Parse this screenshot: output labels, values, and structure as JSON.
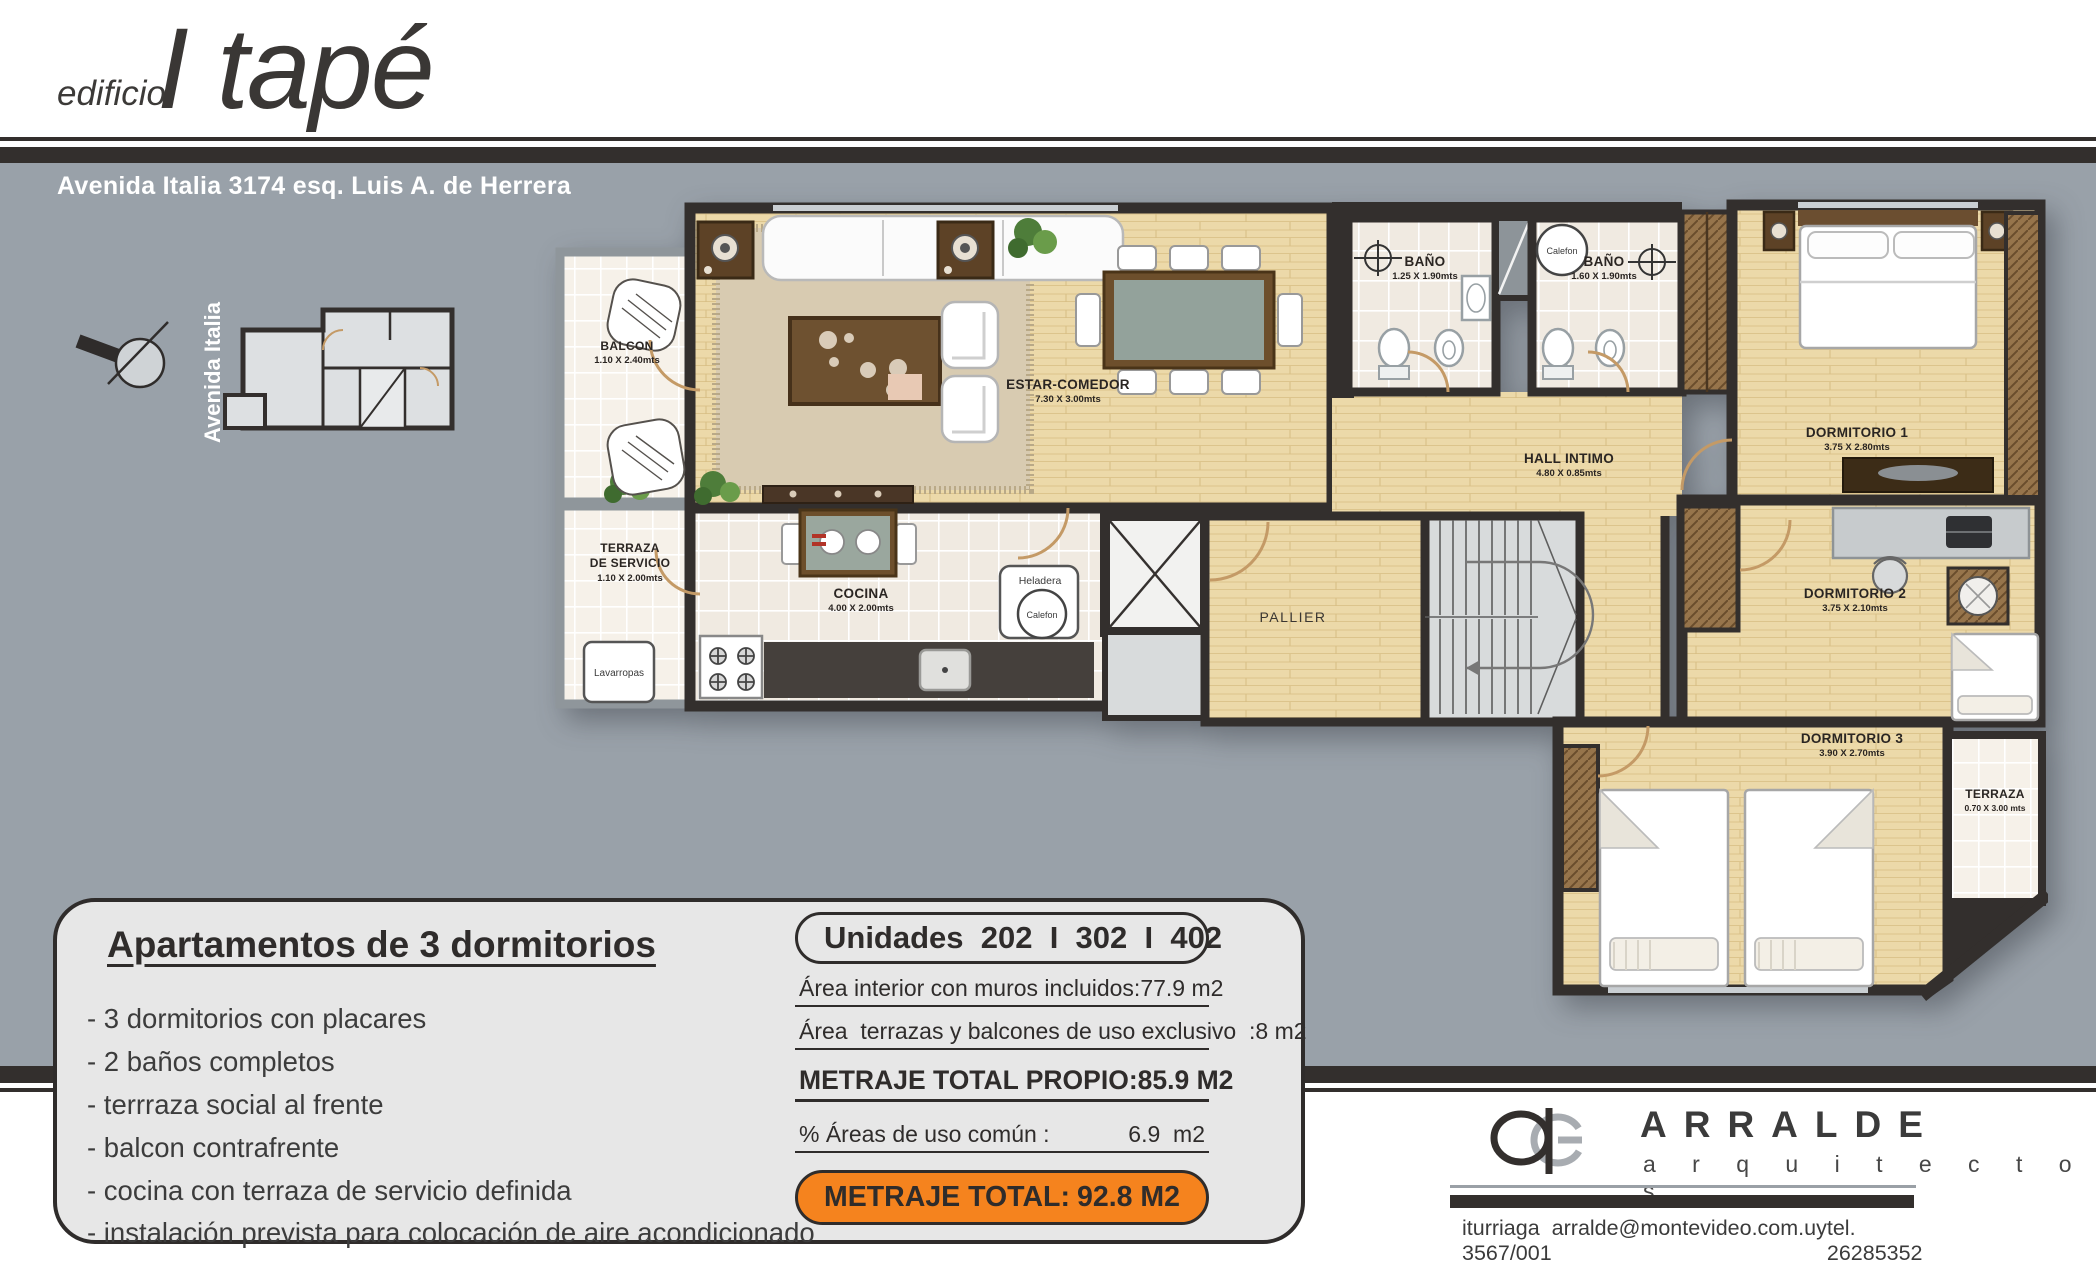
{
  "header": {
    "brand_prefix": "edificio",
    "brand_name": "I tapé",
    "address": "Avenida Italia 3174 esq. Luis A. de Herrera"
  },
  "key_plan": {
    "street_label": "Avenida Italia"
  },
  "plan": {
    "rooms": {
      "balcon": {
        "name": "BALCON",
        "dims": "1.10 X 2.40mts"
      },
      "estar": {
        "name": "ESTAR-COMEDOR",
        "dims": "7.30 X 3.00mts"
      },
      "bano1": {
        "name": "BAÑO",
        "dims": "1.25 X 1.90mts"
      },
      "bano2": {
        "name": "BAÑO",
        "dims": "1.60 X 1.90mts"
      },
      "dorm1": {
        "name": "DORMITORIO 1",
        "dims": "3.75 X 2.80mts"
      },
      "hall": {
        "name": "HALL INTIMO",
        "dims": "4.80 X 0.85mts"
      },
      "dorm2": {
        "name": "DORMITORIO 2",
        "dims": "3.75 X 2.10mts"
      },
      "terraza_servicio": {
        "name_line1": "TERRAZA",
        "name_line2": "DE SERVICIO",
        "dims": "1.10 X 2.00mts"
      },
      "cocina": {
        "name": "COCINA",
        "dims": "4.00 X 2.00mts"
      },
      "pallier": {
        "name": "PALLIER"
      },
      "dorm3": {
        "name": "DORMITORIO 3",
        "dims": "3.90 X 2.70mts"
      },
      "terraza": {
        "name": "TERRAZA",
        "dims": "0.70 X 3.00 mts"
      }
    },
    "labels": {
      "lavarropas": "Lavarropas",
      "heladera": "Heladera",
      "calefon": "Calefon"
    }
  },
  "info_panel": {
    "title": "Apartamentos de 3 dormitorios",
    "features": [
      "- 3 dormitorios con placares",
      "- 2 baños completos",
      "- terrraza social al frente",
      "- balcon contrafrente",
      "- cocina con terraza de servicio definida",
      "- instalación prevista para colocación de aire acondicionado"
    ]
  },
  "units_panel": {
    "title": "Unidades  202  I  302  I  402",
    "rows": [
      {
        "label": "Área interior con muros incluidos:",
        "value": "77.9 m2"
      },
      {
        "label": "Área  terrazas y balcones de uso exclusivo  :",
        "value": "8 m2"
      },
      {
        "label": "METRAJE TOTAL PROPIO:",
        "value": "85.9 M2"
      },
      {
        "label": "% Áreas de uso común :",
        "value": "6.9  m2"
      }
    ],
    "total": {
      "label": "METRAJE TOTAL:",
      "value": "92.8 M2"
    },
    "accent_color": "#f5831e"
  },
  "footer": {
    "firm_name": "ARRALDE",
    "firm_subtitle": "a r q u i t e c t o s",
    "contact_address": "iturriaga 3567/001",
    "contact_email": "arralde@montevideo.com.uy",
    "contact_phone": "tel. 26285352"
  }
}
